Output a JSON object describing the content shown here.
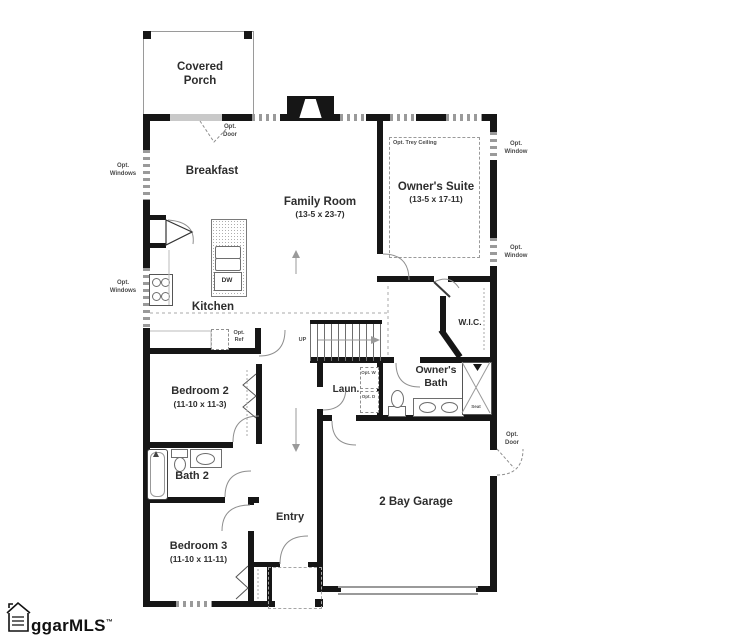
{
  "colors": {
    "wall": "#161616",
    "window_fill": "#9a9a9a",
    "line": "#888888",
    "text": "#2d2d2d"
  },
  "rooms": {
    "covered_porch": {
      "name": "Covered Porch"
    },
    "breakfast": {
      "name": "Breakfast"
    },
    "family_room": {
      "name": "Family Room",
      "dims": "(13-5 x 23-7)"
    },
    "owners_suite": {
      "name": "Owner's Suite",
      "dims": "(13-5 x 17-11)"
    },
    "kitchen": {
      "name": "Kitchen"
    },
    "wic": {
      "name": "W.I.C."
    },
    "owners_bath": {
      "name": "Owner's Bath"
    },
    "laundry": {
      "name": "Laun."
    },
    "bedroom_2": {
      "name": "Bedroom 2",
      "dims": "(11-10 x 11-3)"
    },
    "bath_2": {
      "name": "Bath 2"
    },
    "bedroom_3": {
      "name": "Bedroom 3",
      "dims": "(11-10 x 11-11)"
    },
    "entry": {
      "name": "Entry"
    },
    "garage": {
      "name": "2 Bay Garage"
    }
  },
  "annotations": {
    "porch_opt_door": "Opt. Door",
    "left_opt_windows_top": "Opt. Windows",
    "left_opt_windows_bottom": "Opt. Windows",
    "right_opt_window_top": "Opt. Window",
    "right_opt_window_bottom": "Opt. Window",
    "opt_trey_ceiling": "Opt. Trey Ceiling",
    "opt_ref": "Opt. Ref",
    "stairs_up": "UP",
    "dishwasher": "DW",
    "opt_washer": "Opt. W",
    "opt_dryer": "Opt. D",
    "shower_seat": "Seat",
    "garage_opt_door": "Opt. Door"
  },
  "watermark": {
    "text": "ggarMLS",
    "tm": "™"
  }
}
